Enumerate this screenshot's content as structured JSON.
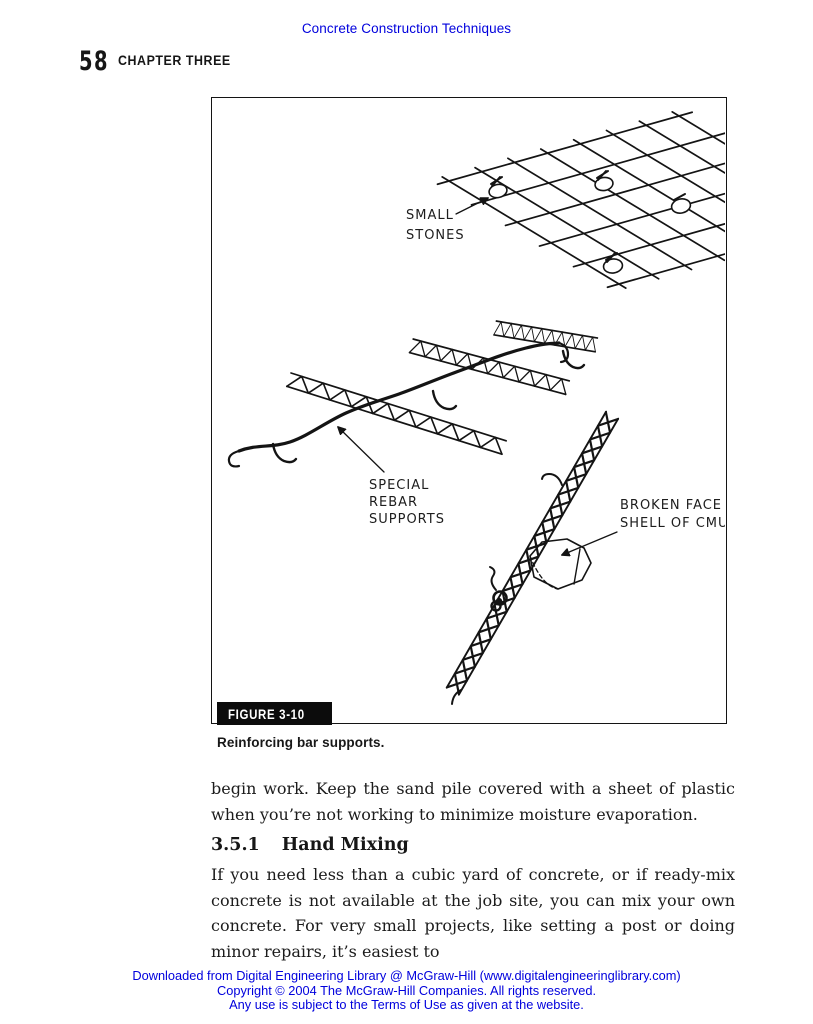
{
  "page": {
    "running_head": "Concrete Construction Techniques",
    "page_number": "58",
    "chapter_label": "CHAPTER THREE"
  },
  "figure": {
    "banner_label": "FIGURE 3-10",
    "caption": "Reinforcing bar supports.",
    "annotations": {
      "small_stones": [
        "SMALL",
        "STONES"
      ],
      "special_rebar_supports": [
        "SPECIAL",
        "REBAR",
        "SUPPORTS"
      ],
      "broken_face_shell": [
        "BROKEN FACE",
        "SHELL OF CMU"
      ]
    }
  },
  "body": {
    "paragraph_1": "begin work. Keep the sand pile covered with a sheet of plastic when you’re not working to minimize moisture evaporation.",
    "section_number": "3.5.1",
    "section_title": "Hand Mixing",
    "paragraph_2": "If you need less than a cubic yard of concrete, or if ready-mix concrete is not available at the job site, you can mix your own concrete. For very small projects, like setting a post or doing minor repairs, it’s easiest to"
  },
  "footer": {
    "line_1": "Downloaded from Digital Engineering Library @ McGraw-Hill (www.digitalengineeringlibrary.com)",
    "line_2": "Copyright © 2004 The McGraw-Hill Companies. All rights reserved.",
    "line_3": "Any use is subject to the Terms of Use as given at the website."
  },
  "colors": {
    "link_blue": "#0000dd",
    "ink_black": "#141414",
    "banner_black": "#0c0c0c"
  }
}
